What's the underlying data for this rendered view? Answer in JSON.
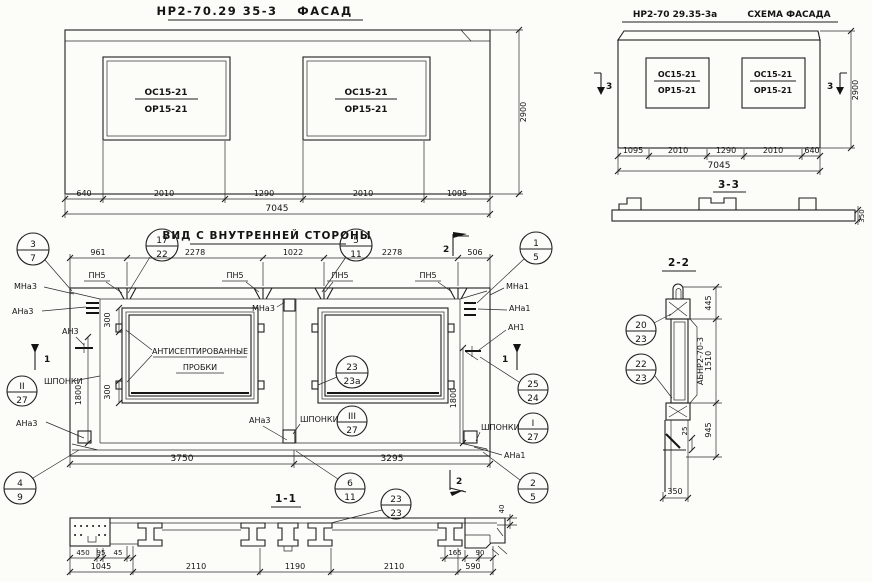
{
  "facade": {
    "mark": "НР2-70.29 35-3",
    "name": "ФАСАД",
    "window": {
      "top": "ОС15-21",
      "bottom": "ОР15-21"
    },
    "dims": [
      "640",
      "2010",
      "1290",
      "2010",
      "1095"
    ],
    "total": "7045",
    "height": "2900"
  },
  "scheme": {
    "mark": "НР2-70 29.35-3а",
    "name": "СХЕМА ФАСАДА",
    "dims": [
      "1095",
      "2010",
      "1290",
      "2010",
      "640"
    ],
    "total": "7045",
    "height": "2900"
  },
  "section33": {
    "title": "3-3",
    "thickness": "350"
  },
  "inner": {
    "title": "ВИД С ВНУТРЕННЕЙ СТОРОНЫ",
    "dims_top": [
      "961",
      "2278",
      "1022",
      "2278",
      "506"
    ],
    "dims_bottom": [
      "3750",
      "3295"
    ],
    "dim_1800": "1800",
    "dim_300": "300",
    "labels": {
      "pn5": "ПН5",
      "mna3": "МНа3",
      "ana3": "АНа3",
      "an3": "АН3",
      "mna1": "МНа1",
      "ana1": "АНа1",
      "an1": "АН1",
      "shponki": "ШПОНКИ",
      "plugs1": "АНТИСЕПТИРОВАННЫЕ",
      "plugs2": "ПРОБКИ"
    },
    "marks": {
      "s1": "1",
      "s2": "2",
      "s3": "3"
    }
  },
  "section11": {
    "title": "1-1",
    "dims_small_left": [
      "450",
      "95",
      "45"
    ],
    "dims_small_right": [
      "165",
      "90"
    ],
    "dim_40": "40",
    "dims": [
      "1045",
      "2110",
      "1190",
      "2110",
      "590"
    ]
  },
  "section22": {
    "title": "2-2",
    "dims": [
      "445",
      "1510",
      "945"
    ],
    "dim_25": "25",
    "dim_350": "350",
    "part": "АБНР2-70-3"
  },
  "balloons": {
    "b3_7": {
      "top": "3",
      "bottom": "7"
    },
    "b17_22": {
      "top": "17",
      "bottom": "22"
    },
    "b5_11": {
      "top": "5",
      "bottom": "11"
    },
    "b1_5": {
      "top": "1",
      "bottom": "5"
    },
    "b2_27": {
      "top": "II",
      "bottom": "27"
    },
    "b23_23a": {
      "top": "23",
      "bottom": "23а"
    },
    "b25_24": {
      "top": "25",
      "bottom": "24"
    },
    "b3_27": {
      "top": "III",
      "bottom": "27"
    },
    "b1_27": {
      "top": "I",
      "bottom": "27"
    },
    "b4_9": {
      "top": "4",
      "bottom": "9"
    },
    "b6_11": {
      "top": "6",
      "bottom": "11"
    },
    "b2_5": {
      "top": "2",
      "bottom": "5"
    },
    "b23_23": {
      "top": "23",
      "bottom": "23"
    },
    "b20_23": {
      "top": "20",
      "bottom": "23"
    },
    "b22_23": {
      "top": "22",
      "bottom": "23"
    }
  }
}
